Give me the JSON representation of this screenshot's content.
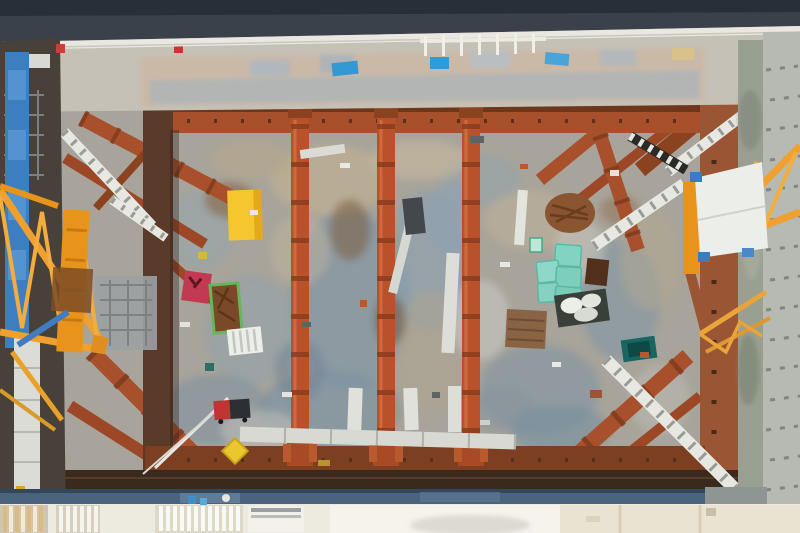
{
  "scene": {
    "title": "Aerial top-down photograph of a rectangular construction excavation pit",
    "description": "Overhead drone view of a deep excavation: rust-orange steel walers frame the pit, three segmented orange cross-struts span vertically, diagonal corner braces with white access walkways cross each corner, a yellow lattice crane boom enters from the left and another from the upper right, and the mottled concrete floor is scattered with equipment, teal containers, a yellow box and crates.",
    "environment": "construction site, daylight"
  },
  "objects": {
    "vertical_struts": {
      "count": 3,
      "label": "segmented rust-orange pipe struts"
    },
    "corner_braces": {
      "count": 8,
      "label": "diagonal rust corner braces"
    },
    "walkways": {
      "count": 6,
      "label": "white access walkways / gangways"
    },
    "teal_containers": {
      "count": 5,
      "label": "teal material containers"
    },
    "cranes": {
      "count": 2,
      "label": "yellow lattice crane booms (left and right)"
    },
    "yellow_box": {
      "count": 1,
      "label": "yellow storage box"
    },
    "red_crate": {
      "count": 1,
      "label": "red material crate"
    },
    "green_crate": {
      "count": 1,
      "label": "green-framed crate with rust materials"
    }
  },
  "colors": {
    "top_band": "#3a414b",
    "top_band_dark": "#272d36",
    "rail_white": "#e9e7e0",
    "ledge": "#c6c1b6",
    "ledge_salmon": "#cfb29a",
    "ledge_blue_streak": "#9fb2c0",
    "pit_floor": "#a8a49b",
    "waler_rust": "#a8502c",
    "waler_dark": "#5a3a28",
    "waler_bottom": "#7c3f22",
    "bottom_dark_band": "#3a2a1d",
    "strut_orange": "#b9522b",
    "strut_joint": "#8a3c1e",
    "brace_rust": "#a8502c",
    "walkway_white": "#e7e8e2",
    "walkway_rung": "#989c94",
    "crane_yellow": "#efa02e",
    "crane_mast": "#e8941c",
    "panel_white": "#eceee9",
    "panel_blue": "#3d7ec0",
    "left_zone_dark": "#474139",
    "right_wall": "#b6bab3",
    "right_strip": "#9aa091",
    "bottom_blue_stripe": "#4a647d",
    "bottom_light": "#edeae0",
    "box_yellow": "#f6c62e",
    "container_teal": "#82d4c0",
    "crate_red": "#c13a52",
    "crate_green": "#62b85a",
    "tarp_blue": "#3498d4",
    "shadow_debris": "#8295a5"
  }
}
